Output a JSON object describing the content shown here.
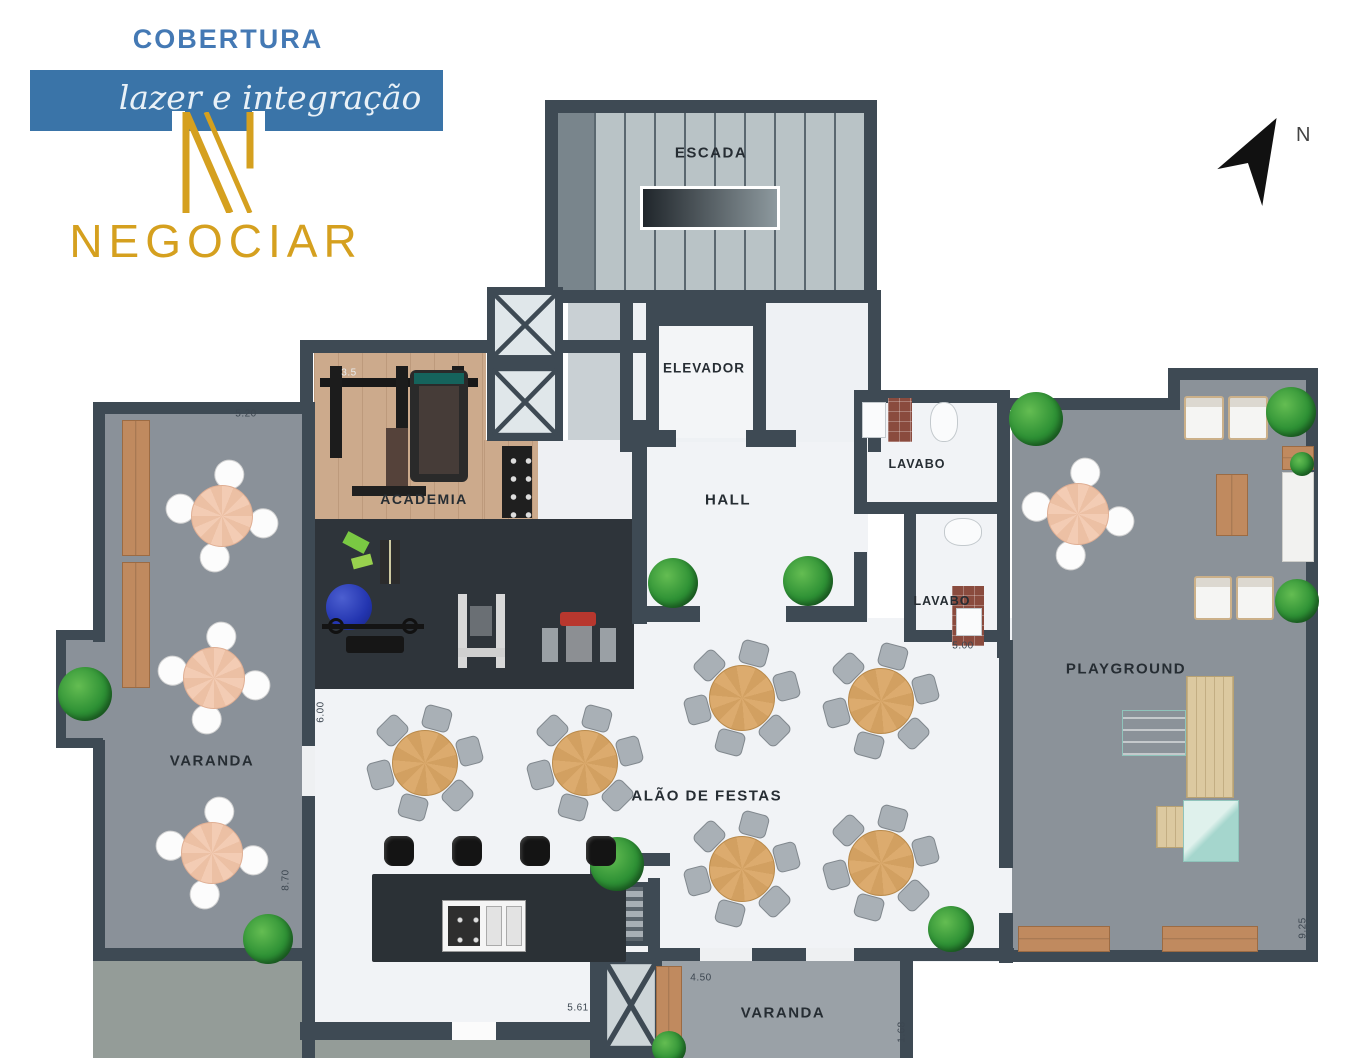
{
  "branding": {
    "title": "COBERTURA",
    "tagline": "lazer e integração",
    "logo_name": "NEGOCIAR"
  },
  "compass": {
    "label": "N"
  },
  "rooms": {
    "escada": "ESCADA",
    "elevador": "ELEVADOR",
    "hall": "HALL",
    "lavabo_top": "LAVABO",
    "lavabo_bottom": "LAVABO",
    "academia": "ACADEMIA",
    "varanda_left": "VARANDA",
    "salao": "SALÃO DE FESTAS",
    "playground": "PLAYGROUND",
    "varanda_bottom": "VARANDA"
  },
  "dimensions": [
    {
      "value": "5.20",
      "x": 246,
      "y": 414,
      "rot": 0
    },
    {
      "value": "3.5",
      "x": 349,
      "y": 373,
      "rot": 0,
      "light": true
    },
    {
      "value": "5.71",
      "x": 1046,
      "y": 410,
      "rot": 0
    },
    {
      "value": "5.00",
      "x": 963,
      "y": 646,
      "rot": 0
    },
    {
      "value": "6.00",
      "x": 321,
      "y": 712,
      "rot": -90
    },
    {
      "value": "8.70",
      "x": 286,
      "y": 880,
      "rot": -90
    },
    {
      "value": "9.25",
      "x": 1303,
      "y": 928,
      "rot": -90
    },
    {
      "value": "5.61",
      "x": 578,
      "y": 1008,
      "rot": 0
    },
    {
      "value": "4.50",
      "x": 701,
      "y": 978,
      "rot": 0
    },
    {
      "value": "1.68",
      "x": 902,
      "y": 1032,
      "rot": -90
    }
  ],
  "colors": {
    "brand_blue": "#4479b4",
    "banner_blue": "#3a74a8",
    "gold": "#d5a01f",
    "wall": "#3e4a54",
    "marble": "#f1f3f6",
    "terrace": "#8a9199",
    "wood_floor": "#ccaa8c",
    "gym_floor": "#2e343a",
    "table_peach": "#f2c9ae",
    "table_wood": "#d9a96b",
    "plant_green": "#2e8f33",
    "mint": "#b9ded8"
  },
  "furniture": {
    "tables_round4": [
      {
        "x": 222,
        "y": 516
      },
      {
        "x": 214,
        "y": 678
      },
      {
        "x": 212,
        "y": 853
      },
      {
        "x": 1078,
        "y": 514
      }
    ],
    "tables_round6": [
      {
        "x": 425,
        "y": 763
      },
      {
        "x": 585,
        "y": 763
      },
      {
        "x": 742,
        "y": 698
      },
      {
        "x": 881,
        "y": 701
      },
      {
        "x": 742,
        "y": 869
      },
      {
        "x": 881,
        "y": 863
      }
    ],
    "benches": [
      {
        "x": 122,
        "y": 420,
        "w": 28,
        "h": 136
      },
      {
        "x": 122,
        "y": 562,
        "w": 28,
        "h": 126
      },
      {
        "x": 656,
        "y": 966,
        "w": 26,
        "h": 78
      },
      {
        "x": 1018,
        "y": 926,
        "w": 92,
        "h": 26
      },
      {
        "x": 1162,
        "y": 926,
        "w": 96,
        "h": 26
      },
      {
        "x": 1282,
        "y": 446,
        "w": 32,
        "h": 24
      },
      {
        "x": 1216,
        "y": 474,
        "w": 32,
        "h": 62
      }
    ],
    "loungers": [
      {
        "x": 1184,
        "y": 396,
        "w": 40,
        "h": 44
      },
      {
        "x": 1228,
        "y": 396,
        "w": 40,
        "h": 44
      },
      {
        "x": 1194,
        "y": 576,
        "w": 38,
        "h": 44
      },
      {
        "x": 1236,
        "y": 576,
        "w": 38,
        "h": 44
      }
    ],
    "plants": [
      {
        "x": 85,
        "y": 694,
        "r": 27
      },
      {
        "x": 268,
        "y": 939,
        "r": 25
      },
      {
        "x": 673,
        "y": 583,
        "r": 25
      },
      {
        "x": 808,
        "y": 581,
        "r": 25
      },
      {
        "x": 617,
        "y": 864,
        "r": 27
      },
      {
        "x": 951,
        "y": 929,
        "r": 23
      },
      {
        "x": 1036,
        "y": 419,
        "r": 27
      },
      {
        "x": 1291,
        "y": 412,
        "r": 25
      },
      {
        "x": 1297,
        "y": 601,
        "r": 22
      },
      {
        "x": 669,
        "y": 1048,
        "r": 17
      },
      {
        "x": 1302,
        "y": 464,
        "r": 12
      }
    ],
    "stools": [
      {
        "x": 399,
        "y": 851
      },
      {
        "x": 467,
        "y": 851
      },
      {
        "x": 535,
        "y": 851
      },
      {
        "x": 601,
        "y": 851
      }
    ]
  }
}
